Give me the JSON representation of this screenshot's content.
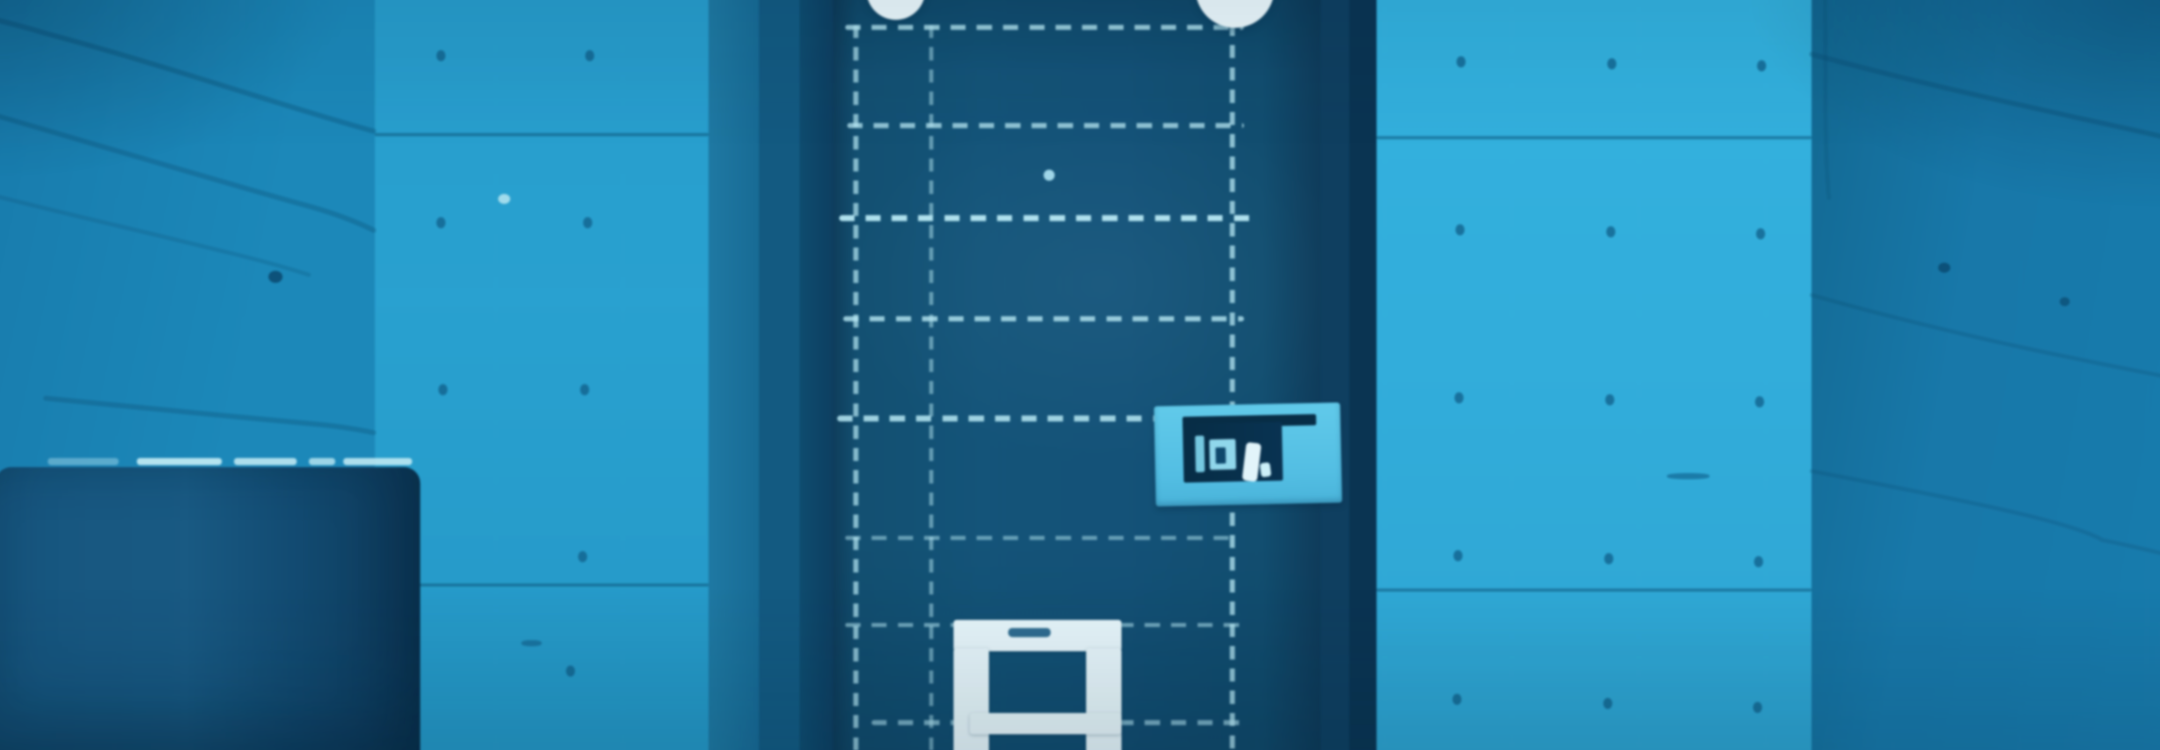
{
  "scene": {
    "description": "Blue-monochrome photograph of a concrete room: dark metal cell door outlined with pale dashed weld lines, two round white lamps at the top edge, a light-blue plate with illegible dark markings on the right side of the door, a white-painted hatch frame at the door bottom, concrete walls with form-tie holes, seams and diagonal cracks, and a dark rounded bin in the lower left corner. No legible text is visible.",
    "palette": {
      "dash": "#b9e7f2",
      "crack": "rgba(12,72,105,0.6)",
      "dot": "#17618a",
      "lamp": "#ebf7fa",
      "hatch": "#e6f4f8",
      "plate": "#5fc2e2",
      "plateDark": "#0a2d45",
      "boxHi": "#bfe7f0",
      "peep": "#a9dcec",
      "doorLeaf": "#185274",
      "wallBrightRight": "#3ab0da",
      "wallBrightLeft": "#2f9fcb",
      "wallAngledLeft": "#2084b1",
      "wallAngledRight": "#1d77a5"
    },
    "door": {
      "h_dashes": [
        {
          "x": 848,
          "y": 29,
          "w": 394,
          "h": 5,
          "o": 0.8
        },
        {
          "x": 850,
          "y": 126,
          "w": 392,
          "h": 5,
          "o": 0.75
        },
        {
          "x": 842,
          "y": 217,
          "w": 408,
          "h": 6,
          "o": 0.95
        },
        {
          "x": 846,
          "y": 317,
          "w": 396,
          "h": 5,
          "o": 0.8
        },
        {
          "x": 840,
          "y": 415,
          "w": 402,
          "h": 6,
          "o": 0.85
        },
        {
          "x": 848,
          "y": 534,
          "w": 390,
          "h": 4,
          "o": 0.5
        },
        {
          "x": 848,
          "y": 620,
          "w": 110,
          "h": 4,
          "o": 0.55
        },
        {
          "x": 1118,
          "y": 620,
          "w": 122,
          "h": 4,
          "o": 0.55
        },
        {
          "x": 874,
          "y": 716,
          "w": 88,
          "h": 5,
          "o": 0.6
        },
        {
          "x": 1118,
          "y": 716,
          "w": 130,
          "h": 5,
          "o": 0.6
        }
      ],
      "v_dashes": [
        {
          "x": 856,
          "y": 29,
          "w": 5,
          "h": 721,
          "o": 0.7
        },
        {
          "x": 931,
          "y": 29,
          "w": 4,
          "h": 721,
          "o": 0.5
        },
        {
          "x": 1228,
          "y": 27,
          "w": 5,
          "h": 723,
          "o": 0.75
        }
      ]
    },
    "sign": {
      "glyphs": [
        {
          "x": 40,
          "y": 30,
          "w": 9,
          "h": 36,
          "c": "#79c6dd",
          "r": 0,
          "br": 2
        },
        {
          "x": 54,
          "y": 34,
          "w": 26,
          "h": 30,
          "c": "#93d5e8",
          "r": 0,
          "br": 2
        },
        {
          "x": 60,
          "y": 42,
          "w": 10,
          "h": 16,
          "c": "#12486a",
          "r": 0,
          "br": 1
        },
        {
          "x": 88,
          "y": 38,
          "w": 15,
          "h": 38,
          "c": "#e2f3f8",
          "r": 8,
          "br": 4
        },
        {
          "x": 104,
          "y": 58,
          "w": 10,
          "h": 14,
          "c": "#cdeef6",
          "r": -6,
          "br": 3
        }
      ]
    },
    "walls": {
      "seams": [
        {
          "x": 383,
          "y": 136,
          "w": 330
        },
        {
          "x": 383,
          "y": 581,
          "w": 330
        },
        {
          "x": 1373,
          "y": 139,
          "w": 430
        },
        {
          "x": 1373,
          "y": 586,
          "w": 430
        }
      ],
      "tie_holes": [
        [
          444,
          54
        ],
        [
          591,
          54
        ],
        [
          444,
          219
        ],
        [
          589,
          219
        ],
        [
          446,
          384
        ],
        [
          586,
          384
        ],
        [
          584,
          549
        ],
        [
          572,
          662
        ],
        [
          1452,
          60
        ],
        [
          1601,
          62
        ],
        [
          1749,
          64
        ],
        [
          1451,
          226
        ],
        [
          1600,
          228
        ],
        [
          1748,
          230
        ],
        [
          1450,
          392
        ],
        [
          1599,
          394
        ],
        [
          1747,
          396
        ],
        [
          1449,
          548
        ],
        [
          1598,
          551
        ],
        [
          1746,
          554
        ],
        [
          1448,
          690
        ],
        [
          1597,
          694
        ],
        [
          1745,
          698
        ]
      ],
      "specks": [
        {
          "x": 505,
          "y": 196,
          "w": 12,
          "h": 10,
          "c": "#bfe7f0",
          "br": "50%",
          "o": 0.8
        },
        {
          "x": 278,
          "y": 272,
          "w": 14,
          "h": 12,
          "c": "#0e4568",
          "br": "50%",
          "o": 0.8
        },
        {
          "x": 528,
          "y": 637,
          "w": 20,
          "h": 6,
          "c": "#1b6a93",
          "br": "40%",
          "o": 0.8
        },
        {
          "x": 1928,
          "y": 264,
          "w": 12,
          "h": 10,
          "c": "#0e486c",
          "br": "50%",
          "o": 0.8
        },
        {
          "x": 2048,
          "y": 298,
          "w": 10,
          "h": 9,
          "c": "#0f4a6e",
          "br": "50%",
          "o": 0.7
        },
        {
          "x": 1660,
          "y": 472,
          "w": 42,
          "h": 6,
          "c": "#1a6e99",
          "br": "40%",
          "o": 0.8
        }
      ],
      "cracks": [
        {
          "d": "M382,134 C300,112 180,70 60,38 C40,32 18,26 0,22",
          "w": 5,
          "o": 0.55
        },
        {
          "d": "M0,116 C90,142 210,178 310,206 C340,214 362,222 382,232",
          "w": 5,
          "o": 0.5
        },
        {
          "d": "M0,196 C70,214 150,232 230,252 C260,259 290,267 318,276",
          "w": 4,
          "o": 0.35
        },
        {
          "d": "M58,398 C140,406 240,416 330,424 C350,426 368,429 382,432",
          "w": 5,
          "o": 0.5
        },
        {
          "d": "M1803,58 C1890,82 1990,104 2080,124 C2108,130 2136,136 2160,142",
          "w": 5,
          "o": 0.5
        },
        {
          "d": "M1803,296 C1880,318 1980,342 2060,358 C2094,365 2130,372 2160,378",
          "w": 4,
          "o": 0.4
        },
        {
          "d": "M1803,470 C1950,498 2060,520 2090,538 C2115,543 2140,549 2160,554",
          "w": 4,
          "o": 0.38
        },
        {
          "d": "M1816,0 C1818,60 1814,130 1820,200",
          "w": 4,
          "o": 0.3
        }
      ]
    },
    "box": {
      "highlights": [
        {
          "x": 140,
          "w": 84,
          "o": 0.95
        },
        {
          "x": 236,
          "w": 62,
          "o": 0.9
        },
        {
          "x": 310,
          "w": 26,
          "o": 0.8
        },
        {
          "x": 344,
          "w": 68,
          "o": 0.9
        },
        {
          "x": 52,
          "w": 70,
          "o": 0.4
        }
      ]
    }
  }
}
